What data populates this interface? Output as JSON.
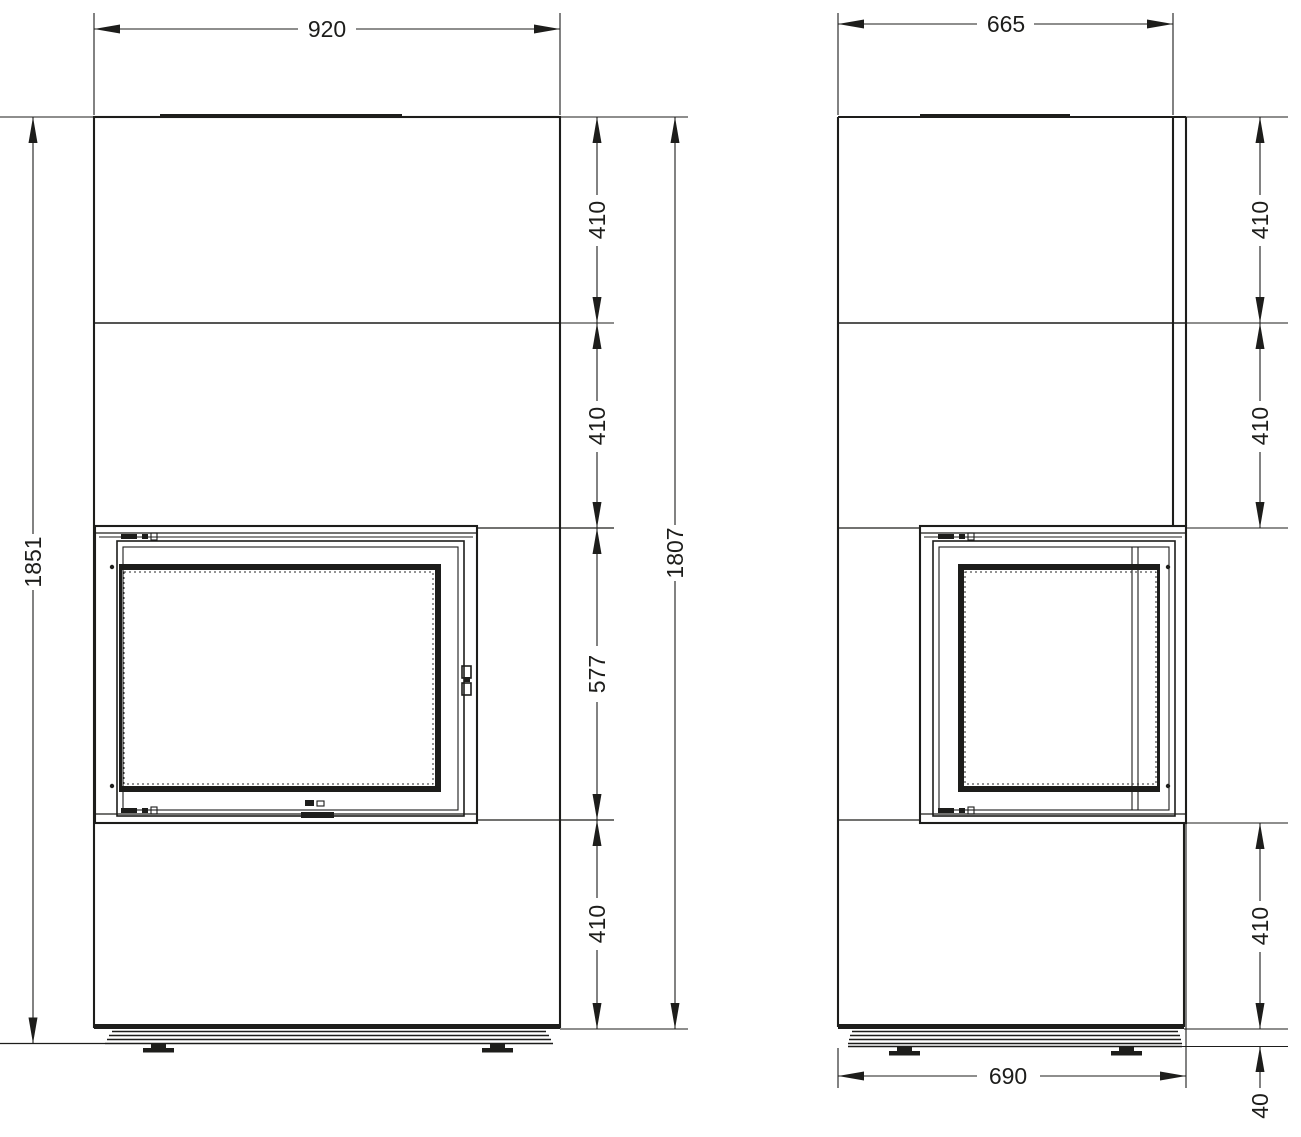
{
  "drawing": {
    "front_view": {
      "width": "920",
      "overall_height": "1851",
      "body_height": "1807",
      "sections": [
        "410",
        "410",
        "577",
        "410"
      ]
    },
    "side_view": {
      "depth": "665",
      "sections": [
        "410",
        "410",
        "410"
      ],
      "plinth_height": "40",
      "base_depth": "690"
    },
    "colors": {
      "line": "#1d1d1b",
      "background": "#ffffff"
    }
  }
}
